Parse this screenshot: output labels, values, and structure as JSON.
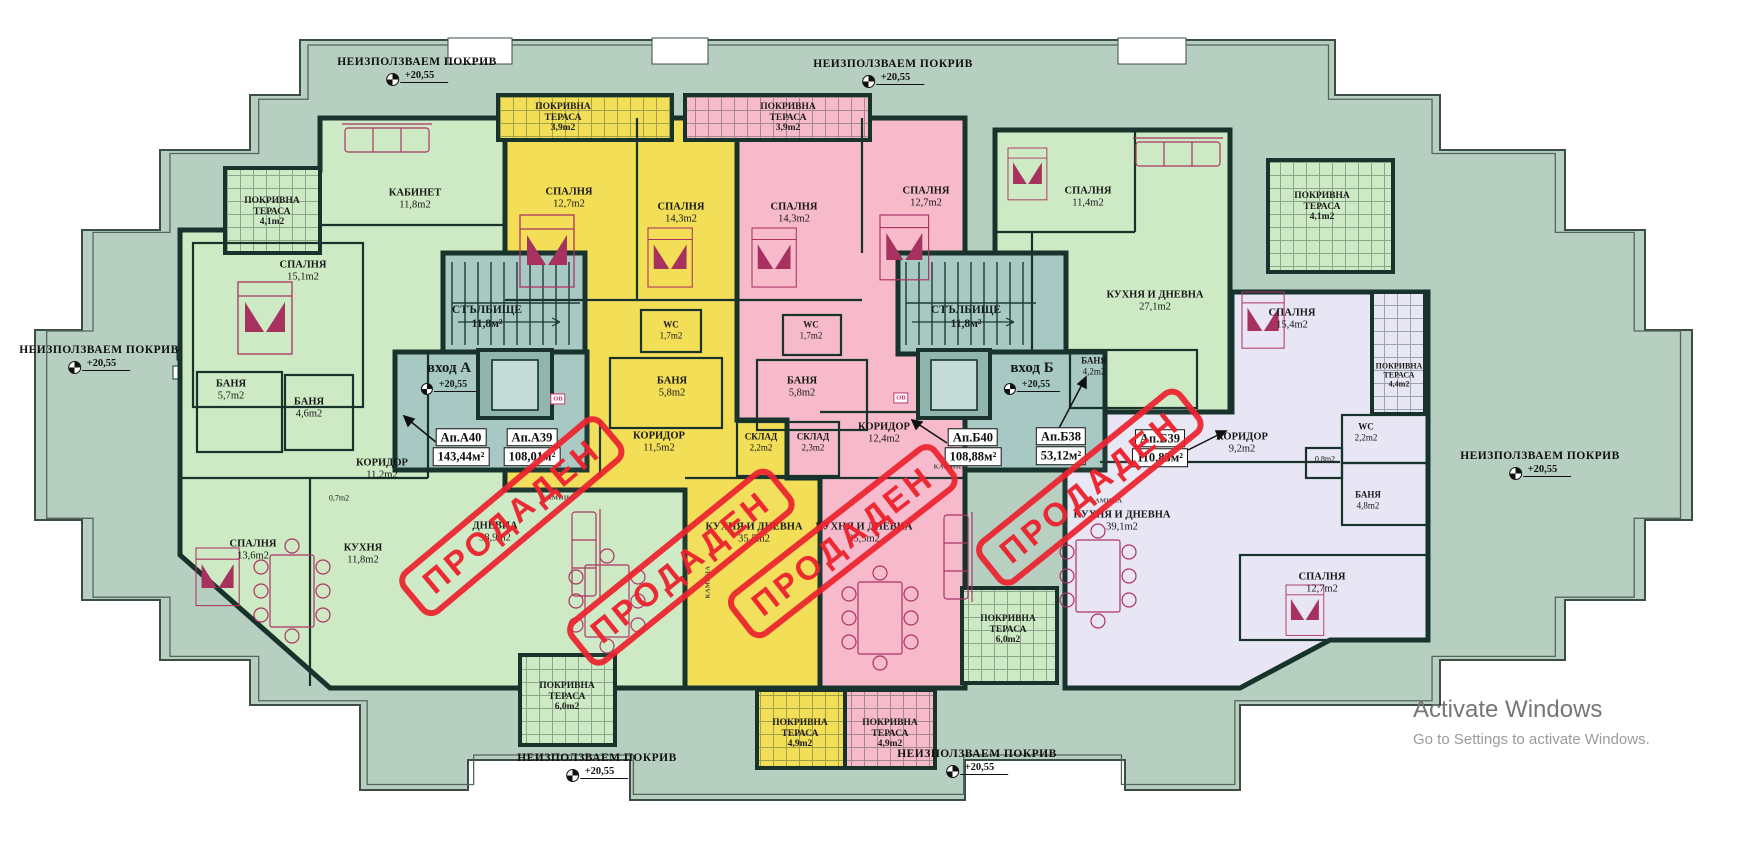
{
  "plan": {
    "unused_roof": {
      "label": "НЕИЗПОЛЗВАЕМ ПОКРИВ",
      "elevation": "+20,55"
    },
    "entrance_a": {
      "label": "вход А",
      "elevation": "+20,55"
    },
    "entrance_b": {
      "label": "вход Б",
      "elevation": "+20,55"
    },
    "stairwell": {
      "name": "СТЪЛБИЩЕ",
      "area": "11,8м²"
    },
    "sold_stamp_text": "ПРОДАДЕН",
    "ov_label": "ОВ",
    "fireplace_label": "КАМИНА",
    "apartments": [
      {
        "id": "Ап.А40",
        "area": "143,44м²"
      },
      {
        "id": "Ап.А39",
        "area": "108,01м²"
      },
      {
        "id": "Ап.Б40",
        "area": "108,88м²"
      },
      {
        "id": "Ап.Б38",
        "area": "53,12м²"
      },
      {
        "id": "Ап.Б39",
        "area": "110,83м²"
      }
    ],
    "rooms": [
      {
        "name": "КАБИНЕТ",
        "area": "11,8m2"
      },
      {
        "name": "СПАЛНЯ",
        "area": "15,1m2"
      },
      {
        "name": "БАНЯ",
        "area": "5,7m2"
      },
      {
        "name": "БАНЯ",
        "area": "4,6m2"
      },
      {
        "name": "КОРИДОР",
        "area": "11,2m2"
      },
      {
        "name": "",
        "area": "0,7m2"
      },
      {
        "name": "СПАЛНЯ",
        "area": "13,6m2"
      },
      {
        "name": "КУХНЯ",
        "area": "11,8m2"
      },
      {
        "name": "ДНЕВНА",
        "area": "38,9m2"
      },
      {
        "name": "СПАЛНЯ",
        "area": "12,7m2"
      },
      {
        "name": "СПАЛНЯ",
        "area": "14,3m2"
      },
      {
        "name": "WC",
        "area": "1,7m2"
      },
      {
        "name": "БАНЯ",
        "area": "5,8m2"
      },
      {
        "name": "КОРИДОР",
        "area": "11,5m2"
      },
      {
        "name": "СКЛАД",
        "area": "2,2m2"
      },
      {
        "name": "КУХНЯ И ДНЕВНА",
        "area": "35,5m2"
      },
      {
        "name": "СПАЛНЯ",
        "area": "14,3m2"
      },
      {
        "name": "СПАЛНЯ",
        "area": "12,7m2"
      },
      {
        "name": "WC",
        "area": "1,7m2"
      },
      {
        "name": "БАНЯ",
        "area": "5,8m2"
      },
      {
        "name": "СКЛАД",
        "area": "2,3m2"
      },
      {
        "name": "КОРИДОР",
        "area": "12,4m2"
      },
      {
        "name": "КУХНЯ И ДНЕВНА",
        "area": "35,5m2"
      },
      {
        "name": "СПАЛНЯ",
        "area": "11,4m2"
      },
      {
        "name": "КУХНЯ И ДНЕВНА",
        "area": "27,1m2"
      },
      {
        "name": "БАНЯ",
        "area": "4,2m2"
      },
      {
        "name": "СПАЛНЯ",
        "area": "15,4m2"
      },
      {
        "name": "КОРИДОР",
        "area": "9,2m2"
      },
      {
        "name": "WC",
        "area": "2,2m2"
      },
      {
        "name": "",
        "area": "0,8m2"
      },
      {
        "name": "БАНЯ",
        "area": "4,8m2"
      },
      {
        "name": "КУХНЯ И ДНЕВНА",
        "area": "39,1m2"
      },
      {
        "name": "СПАЛНЯ",
        "area": "12,7m2"
      }
    ],
    "terraces": [
      {
        "name": "ПОКРИВНА ТЕРАСА",
        "area": "4,1m2"
      },
      {
        "name": "ПОКРИВНА ТЕРАСА",
        "area": "3,9m2"
      },
      {
        "name": "ПОКРИВНА ТЕРАСА",
        "area": "3,9m2"
      },
      {
        "name": "ПОКРИВНА ТЕРАСА",
        "area": "4,1m2"
      },
      {
        "name": "ПОКРИВНА ТЕРАСА",
        "area": "4,4m2"
      },
      {
        "name": "ПОКРИВНА ТЕРАСА",
        "area": "6,0m2"
      },
      {
        "name": "ПОКРИВНА ТЕРАСА",
        "area": "4,9m2"
      },
      {
        "name": "ПОКРИВНА ТЕРАСА",
        "area": "4,9m2"
      },
      {
        "name": "ПОКРИВНА ТЕРАСА",
        "area": "6,0m2"
      }
    ],
    "colors": {
      "roof_sage": "#b6cfc0",
      "apartment_green": "#cdeac4",
      "apartment_yellow": "#f2de57",
      "apartment_pink": "#f6bacb",
      "apartment_lavender": "#e8e6f4",
      "stairwell_teal": "#a8c8c3",
      "wall": "#17332c",
      "stamp_red": "#ec222e",
      "furniture": "#ad3365"
    }
  },
  "watermark": {
    "line1": "Activate Windows",
    "line2": "Go to Settings to activate Windows."
  }
}
